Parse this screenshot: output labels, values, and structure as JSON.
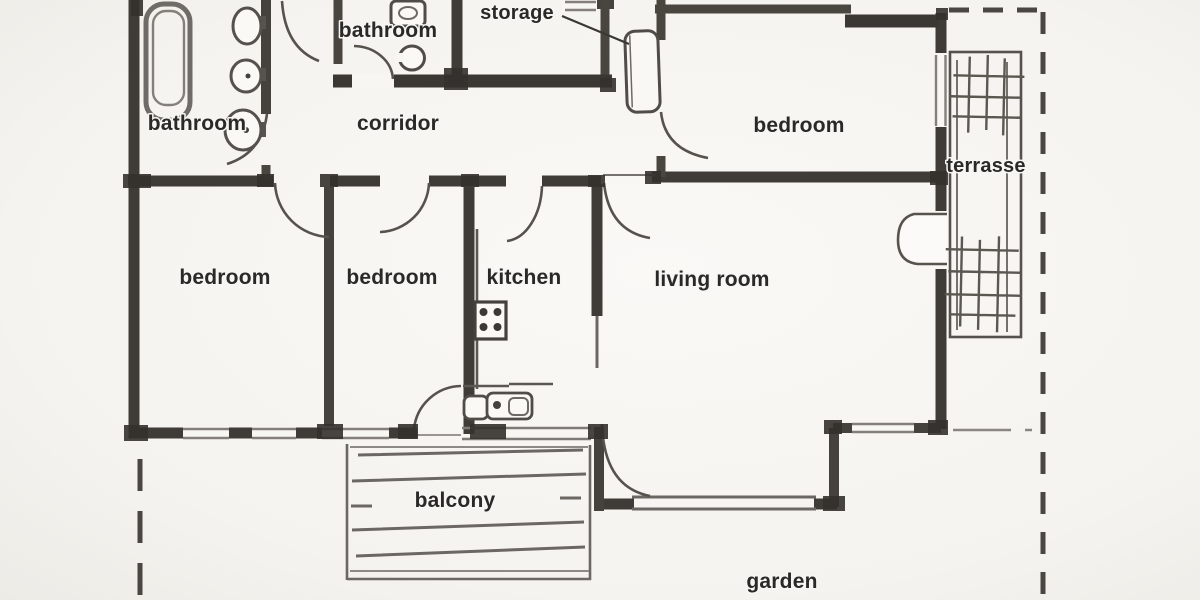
{
  "title": "hand-drawn apartment floor plan sketch",
  "colors": {
    "background": "#f7f6f3",
    "wall": "#3f3c38",
    "thin_line": "#6b6763",
    "light_line": "#8d8985",
    "text": "#2b2927",
    "boundary_dash": "#4a4742"
  },
  "labels": {
    "bathroom_left": "bathroom",
    "bathroom_top": "bathroom",
    "storage": "storage",
    "corridor": "corridor",
    "bedroom_top_right": "bedroom",
    "terrasse": "terrasse",
    "bedroom_left": "bedroom",
    "bedroom_middle": "bedroom",
    "kitchen": "kitchen",
    "living_room": "living room",
    "balcony": "balcony",
    "garden": "garden"
  },
  "rooms": [
    "bathroom",
    "bathroom",
    "storage",
    "corridor",
    "bedroom",
    "terrasse",
    "bedroom",
    "bedroom",
    "kitchen",
    "living room",
    "balcony",
    "garden"
  ]
}
